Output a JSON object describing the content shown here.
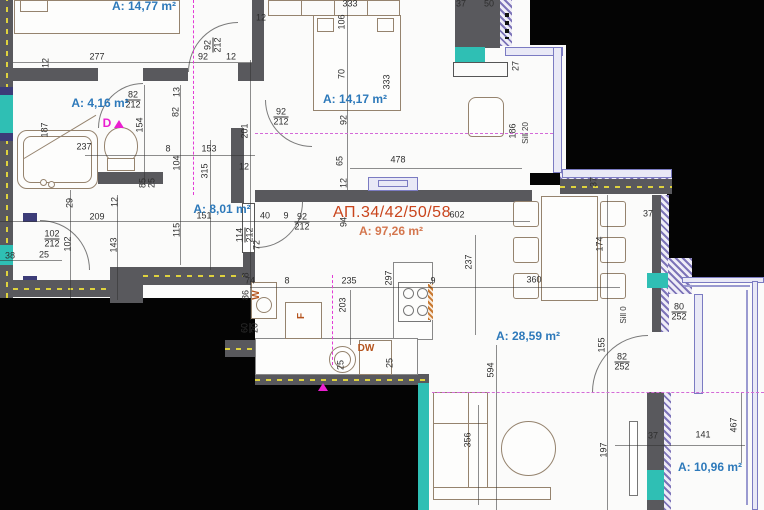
{
  "plan": {
    "apartment_label": "АП.34/42/50/58",
    "apartment_area": "A: 97,26 m²",
    "rooms": [
      {
        "label": "A: 14,77 m²",
        "x": 144,
        "y": 6
      },
      {
        "label": "A: 4,16 m²",
        "x": 100,
        "y": 103
      },
      {
        "label": "A: 14,17 m²",
        "x": 355,
        "y": 99
      },
      {
        "label": "A: 8,01 m²",
        "x": 222,
        "y": 209
      },
      {
        "label": "A: 28,59 m²",
        "x": 528,
        "y": 336
      },
      {
        "label": "A: 10,96 m²",
        "x": 710,
        "y": 467
      }
    ],
    "labels": [
      {
        "t": "277",
        "x": 97,
        "y": 57
      },
      {
        "t": "92",
        "x": 203,
        "y": 57
      },
      {
        "t": "12",
        "x": 231,
        "y": 57
      },
      {
        "t": "92",
        "f": "212",
        "x": 213,
        "y": 45,
        "r": 1
      },
      {
        "t": "12",
        "x": 46,
        "y": 63,
        "r": 1
      },
      {
        "t": "333",
        "x": 350,
        "y": 4
      },
      {
        "t": "12",
        "x": 261,
        "y": 18
      },
      {
        "t": "37",
        "x": 461,
        "y": 4
      },
      {
        "t": "50",
        "x": 489,
        "y": 4
      },
      {
        "t": "106",
        "x": 342,
        "y": 22,
        "r": 1
      },
      {
        "t": "70",
        "x": 342,
        "y": 74,
        "r": 1
      },
      {
        "t": "333",
        "x": 387,
        "y": 82,
        "r": 1
      },
      {
        "t": "92",
        "x": 344,
        "y": 120,
        "r": 1
      },
      {
        "t": "92",
        "f": "212",
        "x": 281,
        "y": 117
      },
      {
        "t": "65",
        "x": 340,
        "y": 161,
        "r": 1
      },
      {
        "t": "12",
        "x": 344,
        "y": 183,
        "r": 1
      },
      {
        "t": "478",
        "x": 398,
        "y": 160
      },
      {
        "t": "27",
        "x": 516,
        "y": 66,
        "r": 1
      },
      {
        "t": "186",
        "x": 513,
        "y": 131,
        "r": 1
      },
      {
        "t": "Sill 20",
        "x": 526,
        "y": 133,
        "r": 1,
        "k": "sill"
      },
      {
        "t": "187",
        "x": 45,
        "y": 130,
        "r": 1
      },
      {
        "t": "237",
        "x": 84,
        "y": 147
      },
      {
        "t": "82",
        "f": "212",
        "x": 133,
        "y": 100
      },
      {
        "t": "154",
        "x": 140,
        "y": 125,
        "r": 1
      },
      {
        "t": "13",
        "x": 177,
        "y": 92,
        "r": 1
      },
      {
        "t": "82",
        "x": 176,
        "y": 112,
        "r": 1
      },
      {
        "t": "8",
        "x": 168,
        "y": 149
      },
      {
        "t": "153",
        "x": 209,
        "y": 149
      },
      {
        "t": "104",
        "x": 177,
        "y": 163,
        "r": 1
      },
      {
        "t": "315",
        "x": 205,
        "y": 171,
        "r": 1
      },
      {
        "t": "201",
        "x": 245,
        "y": 131,
        "r": 1
      },
      {
        "t": "12",
        "x": 244,
        "y": 167
      },
      {
        "t": "85",
        "x": 143,
        "y": 183,
        "r": 1
      },
      {
        "t": "25",
        "x": 152,
        "y": 183,
        "r": 1
      },
      {
        "t": "29",
        "x": 70,
        "y": 203,
        "r": 1
      },
      {
        "t": "209",
        "x": 97,
        "y": 217
      },
      {
        "t": "151",
        "x": 204,
        "y": 216
      },
      {
        "t": "12",
        "x": 115,
        "y": 202,
        "r": 1
      },
      {
        "t": "143",
        "x": 114,
        "y": 245,
        "r": 1
      },
      {
        "t": "102",
        "x": 68,
        "y": 244,
        "r": 1
      },
      {
        "t": "102",
        "f": "212",
        "x": 52,
        "y": 239
      },
      {
        "t": "38",
        "x": 10,
        "y": 256
      },
      {
        "t": "25",
        "x": 44,
        "y": 255
      },
      {
        "t": "115",
        "x": 177,
        "y": 230,
        "r": 1
      },
      {
        "t": "114",
        "f": "212",
        "x": 245,
        "y": 235,
        "r": 1
      },
      {
        "t": "8",
        "x": 246,
        "y": 275,
        "r": 1
      },
      {
        "t": "86",
        "x": 246,
        "y": 295,
        "r": 1
      },
      {
        "t": "40",
        "x": 265,
        "y": 216
      },
      {
        "t": "9",
        "x": 286,
        "y": 216
      },
      {
        "t": "92",
        "f": "212",
        "x": 302,
        "y": 222
      },
      {
        "t": "602",
        "x": 457,
        "y": 215
      },
      {
        "t": "94",
        "x": 344,
        "y": 222,
        "r": 1
      },
      {
        "t": "72",
        "x": 257,
        "y": 245,
        "r": 1
      },
      {
        "t": "74",
        "x": 250,
        "y": 281
      },
      {
        "t": "8",
        "x": 287,
        "y": 281
      },
      {
        "t": "60",
        "f": "20",
        "x": 250,
        "y": 328,
        "r": 1
      },
      {
        "t": "235",
        "x": 349,
        "y": 281
      },
      {
        "t": "9",
        "x": 433,
        "y": 281
      },
      {
        "t": "203",
        "x": 343,
        "y": 305,
        "r": 1
      },
      {
        "t": "297",
        "x": 389,
        "y": 278,
        "r": 1
      },
      {
        "t": "237",
        "x": 469,
        "y": 262,
        "r": 1
      },
      {
        "t": "25",
        "x": 341,
        "y": 365,
        "r": 1
      },
      {
        "t": "25",
        "x": 390,
        "y": 363,
        "r": 1
      },
      {
        "t": "594",
        "x": 491,
        "y": 370,
        "r": 1
      },
      {
        "t": "356",
        "x": 468,
        "y": 440,
        "r": 1
      },
      {
        "t": "360",
        "x": 534,
        "y": 280
      },
      {
        "t": "174",
        "x": 600,
        "y": 244,
        "r": 1
      },
      {
        "t": "37",
        "x": 594,
        "y": 182,
        "r": 1
      },
      {
        "t": "37",
        "x": 648,
        "y": 214
      },
      {
        "t": "80",
        "f": "252",
        "x": 679,
        "y": 312
      },
      {
        "t": "Sill 0",
        "x": 624,
        "y": 315,
        "r": 1,
        "k": "sill"
      },
      {
        "t": "82",
        "f": "252",
        "x": 622,
        "y": 362
      },
      {
        "t": "155",
        "x": 602,
        "y": 345,
        "r": 1
      },
      {
        "t": "197",
        "x": 604,
        "y": 450,
        "r": 1
      },
      {
        "t": "37",
        "x": 653,
        "y": 436
      },
      {
        "t": "141",
        "x": 703,
        "y": 435
      },
      {
        "t": "467",
        "x": 734,
        "y": 425,
        "r": 1
      },
      {
        "t": "W",
        "x": 257,
        "y": 295,
        "r": 1,
        "k": "app"
      },
      {
        "t": "F",
        "x": 302,
        "y": 316,
        "r": 1,
        "k": "app"
      },
      {
        "t": "DW",
        "x": 366,
        "y": 349,
        "k": "app"
      },
      {
        "t": "D",
        "x": 107,
        "y": 123,
        "k": "mag"
      }
    ],
    "colors": {
      "wall": "#59595d",
      "teal_finish": "#2fbfb4",
      "window_frame": "#7b7bc2",
      "insulation_hatch": "#7d74b8",
      "insulation_dash": "#ded23e",
      "room_label": "#2d79ba",
      "apartment_label": "#c9441c",
      "section_line": "#ea1fd0"
    }
  }
}
